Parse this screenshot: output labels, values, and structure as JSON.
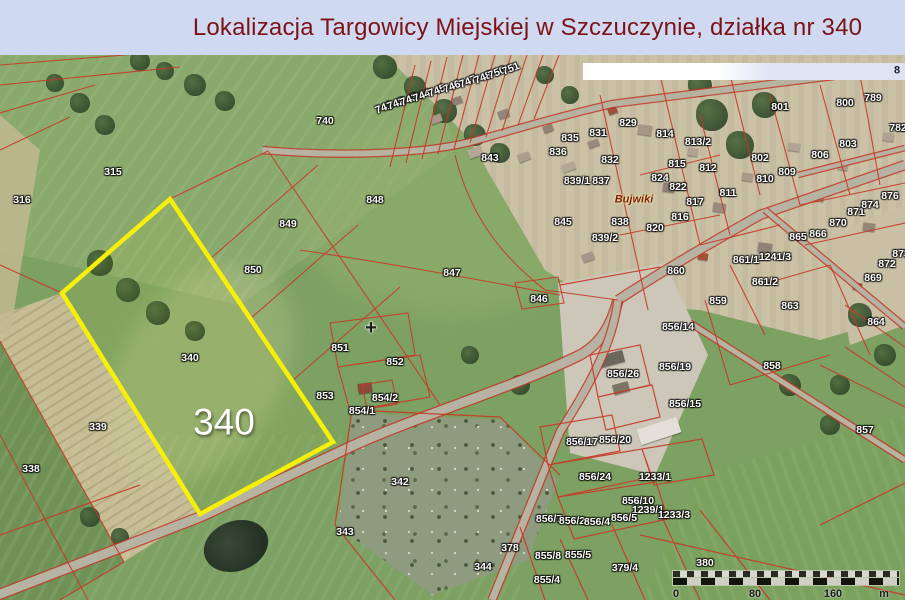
{
  "title": "Lokalizacja Targowicy Miejskiej w Szczuczynie, działka nr 340",
  "map": {
    "place_name": "Bujwiki",
    "survey_cross": "+",
    "highlight_parcel_number": "340",
    "white_bar_digit": "8",
    "scale_bar": {
      "ticks": [
        "0",
        "80",
        "160"
      ],
      "unit": "m"
    },
    "colors": {
      "highlight_outline": "#f6ef0a",
      "cadastral_line": "#c63826",
      "title_text": "#7c1315",
      "title_background": "#cfd9f1"
    },
    "parcel_labels": [
      {
        "t": "315",
        "x": 113,
        "y": 117
      },
      {
        "t": "316",
        "x": 22,
        "y": 145
      },
      {
        "t": "740",
        "x": 325,
        "y": 66
      },
      {
        "t": "849",
        "x": 288,
        "y": 169
      },
      {
        "t": "850",
        "x": 253,
        "y": 215
      },
      {
        "t": "848",
        "x": 375,
        "y": 145
      },
      {
        "t": "843",
        "x": 490,
        "y": 103
      },
      {
        "t": "847",
        "x": 452,
        "y": 218
      },
      {
        "t": "846",
        "x": 539,
        "y": 244
      },
      {
        "t": "851",
        "x": 340,
        "y": 293
      },
      {
        "t": "852",
        "x": 395,
        "y": 307
      },
      {
        "t": "853",
        "x": 325,
        "y": 341
      },
      {
        "t": "854/2",
        "x": 385,
        "y": 343
      },
      {
        "t": "854/1",
        "x": 362,
        "y": 356
      },
      {
        "t": "342",
        "x": 400,
        "y": 427
      },
      {
        "t": "343",
        "x": 345,
        "y": 477
      },
      {
        "t": "344",
        "x": 483,
        "y": 512
      },
      {
        "t": "378",
        "x": 510,
        "y": 493
      },
      {
        "t": "379/4",
        "x": 625,
        "y": 513
      },
      {
        "t": "380",
        "x": 705,
        "y": 508
      },
      {
        "t": "338",
        "x": 31,
        "y": 414
      },
      {
        "t": "339",
        "x": 98,
        "y": 372
      },
      {
        "t": "340",
        "x": 190,
        "y": 303
      },
      {
        "t": "340",
        "x": 224,
        "y": 367,
        "c": "big"
      },
      {
        "t": "741",
        "x": 384,
        "y": 53,
        "r": -22
      },
      {
        "t": "742",
        "x": 396,
        "y": 49,
        "r": -22
      },
      {
        "t": "743",
        "x": 409,
        "y": 45,
        "r": -22
      },
      {
        "t": "744",
        "x": 422,
        "y": 41,
        "r": -22
      },
      {
        "t": "745",
        "x": 437,
        "y": 36,
        "r": -22
      },
      {
        "t": "746",
        "x": 452,
        "y": 32,
        "r": -22
      },
      {
        "t": "747",
        "x": 468,
        "y": 27,
        "r": -22
      },
      {
        "t": "748",
        "x": 483,
        "y": 23,
        "r": -22
      },
      {
        "t": "750",
        "x": 497,
        "y": 18,
        "r": -22
      },
      {
        "t": "751",
        "x": 511,
        "y": 14,
        "r": -22
      },
      {
        "t": "829",
        "x": 628,
        "y": 68
      },
      {
        "t": "831",
        "x": 598,
        "y": 78
      },
      {
        "t": "814",
        "x": 665,
        "y": 79
      },
      {
        "t": "813/2",
        "x": 698,
        "y": 87
      },
      {
        "t": "832",
        "x": 610,
        "y": 105
      },
      {
        "t": "815",
        "x": 677,
        "y": 109
      },
      {
        "t": "812",
        "x": 708,
        "y": 113
      },
      {
        "t": "802",
        "x": 760,
        "y": 103
      },
      {
        "t": "806",
        "x": 820,
        "y": 100
      },
      {
        "t": "803",
        "x": 848,
        "y": 89
      },
      {
        "t": "801",
        "x": 780,
        "y": 52
      },
      {
        "t": "800",
        "x": 845,
        "y": 48
      },
      {
        "t": "789",
        "x": 873,
        "y": 43
      },
      {
        "t": "782",
        "x": 898,
        "y": 73
      },
      {
        "t": "824",
        "x": 660,
        "y": 123
      },
      {
        "t": "822",
        "x": 678,
        "y": 132
      },
      {
        "t": "811",
        "x": 728,
        "y": 138
      },
      {
        "t": "809",
        "x": 787,
        "y": 117
      },
      {
        "t": "810",
        "x": 765,
        "y": 124
      },
      {
        "t": "836",
        "x": 558,
        "y": 97
      },
      {
        "t": "835",
        "x": 570,
        "y": 83
      },
      {
        "t": "839/1",
        "x": 577,
        "y": 126
      },
      {
        "t": "837",
        "x": 601,
        "y": 126
      },
      {
        "t": "845",
        "x": 563,
        "y": 167
      },
      {
        "t": "838",
        "x": 620,
        "y": 167
      },
      {
        "t": "820",
        "x": 655,
        "y": 173
      },
      {
        "t": "816",
        "x": 680,
        "y": 162
      },
      {
        "t": "817",
        "x": 695,
        "y": 147
      },
      {
        "t": "839/2",
        "x": 605,
        "y": 183
      },
      {
        "t": "Bujwiki",
        "x": 634,
        "y": 145,
        "c": "place"
      },
      {
        "t": "865",
        "x": 798,
        "y": 182
      },
      {
        "t": "866",
        "x": 818,
        "y": 179
      },
      {
        "t": "870",
        "x": 838,
        "y": 168
      },
      {
        "t": "871",
        "x": 856,
        "y": 157
      },
      {
        "t": "874",
        "x": 870,
        "y": 150
      },
      {
        "t": "876",
        "x": 890,
        "y": 141
      },
      {
        "t": "1241/3",
        "x": 775,
        "y": 202
      },
      {
        "t": "861/1",
        "x": 746,
        "y": 205
      },
      {
        "t": "861/2",
        "x": 765,
        "y": 227
      },
      {
        "t": "863",
        "x": 790,
        "y": 251
      },
      {
        "t": "872",
        "x": 887,
        "y": 209
      },
      {
        "t": "869",
        "x": 873,
        "y": 223
      },
      {
        "t": "873",
        "x": 901,
        "y": 199
      },
      {
        "t": "864",
        "x": 876,
        "y": 267
      },
      {
        "t": "859",
        "x": 718,
        "y": 246
      },
      {
        "t": "860",
        "x": 676,
        "y": 216
      },
      {
        "t": "858",
        "x": 772,
        "y": 311
      },
      {
        "t": "857",
        "x": 865,
        "y": 375
      },
      {
        "t": "856/14",
        "x": 678,
        "y": 272
      },
      {
        "t": "856/26",
        "x": 623,
        "y": 319
      },
      {
        "t": "856/19",
        "x": 675,
        "y": 312
      },
      {
        "t": "856/15",
        "x": 685,
        "y": 349
      },
      {
        "t": "856/17",
        "x": 582,
        "y": 387
      },
      {
        "t": "856/20",
        "x": 615,
        "y": 385
      },
      {
        "t": "856/24",
        "x": 595,
        "y": 422
      },
      {
        "t": "1233/1",
        "x": 655,
        "y": 422
      },
      {
        "t": "856/10",
        "x": 638,
        "y": 446
      },
      {
        "t": "1239/1",
        "x": 648,
        "y": 455
      },
      {
        "t": "1233/3",
        "x": 674,
        "y": 460
      },
      {
        "t": "856/7",
        "x": 549,
        "y": 464
      },
      {
        "t": "856/2",
        "x": 572,
        "y": 466
      },
      {
        "t": "856/4",
        "x": 597,
        "y": 467
      },
      {
        "t": "856/5",
        "x": 624,
        "y": 463
      },
      {
        "t": "855/8",
        "x": 548,
        "y": 501
      },
      {
        "t": "855/5",
        "x": 578,
        "y": 500
      },
      {
        "t": "855/4",
        "x": 547,
        "y": 525
      },
      {
        "t": "+",
        "x": 371,
        "y": 273,
        "c": "cross"
      }
    ]
  }
}
